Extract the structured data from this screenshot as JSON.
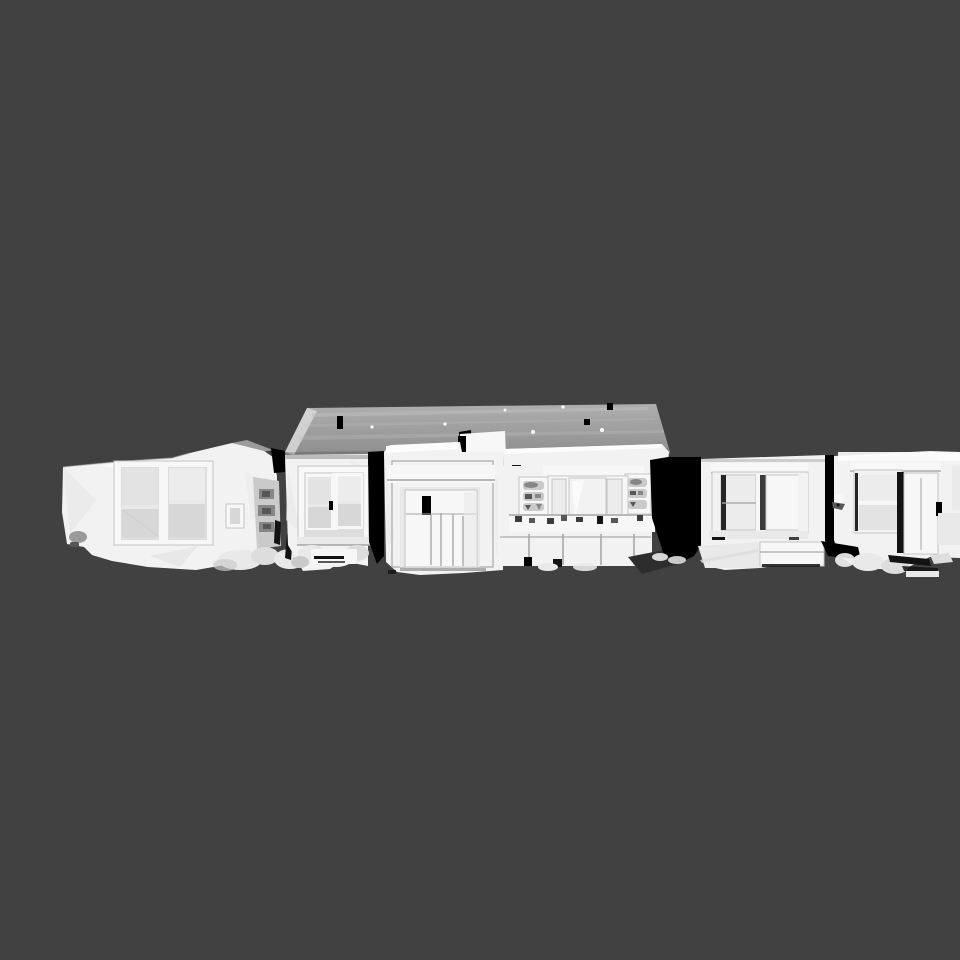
{
  "viewport": {
    "background": "#414141",
    "content_description": "Untextured white 3D scan mesh of a row of single-story house facades with roof, windows, shutters and front door, viewed straight on against a flat dark gray background"
  },
  "colors": {
    "background": "#414141",
    "black": "#000000",
    "ink": "#131313",
    "dark_accent": "#262626",
    "wall": "#f2f2f2",
    "wall_bright": "#fcfcfc",
    "wall_dim": "#e9e9e9",
    "wall_shade": "#dddddd",
    "trim": "#f7f7f7",
    "pane_light": "#ececec",
    "pane": "#e3e3e3",
    "pane_dark": "#d7d7d7",
    "roof_hi": "#afafaf",
    "roof_lo": "#8c8c8c",
    "roof_streak": "#bfbfbf",
    "metal_gray": "#9a9a9a",
    "debris": "#cacaca",
    "debris_dark": "#868686",
    "crevice": "#575757",
    "fade": "#2d2d2d",
    "plant": "#3c3c3c",
    "edge": "#c4c4c4",
    "edge_dark": "#a8a8a8",
    "muntin": "#cfcfcf"
  }
}
